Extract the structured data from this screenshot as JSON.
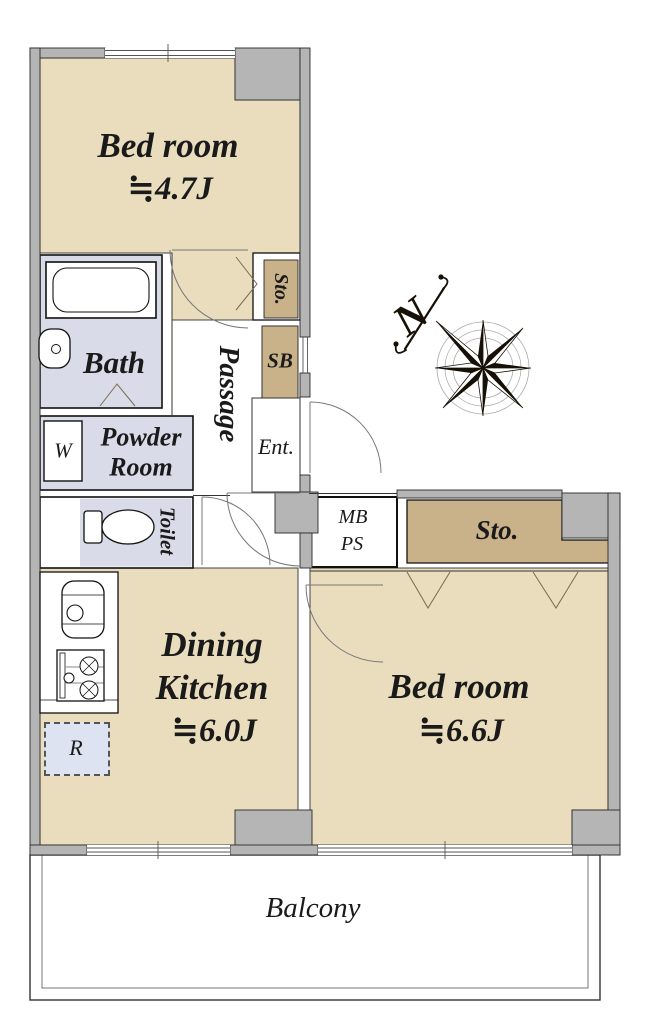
{
  "colors": {
    "room_fill": "#e9ddbe",
    "closet_fill": "#c9b28a",
    "wet_fill": "#d9dce8",
    "wall_fill": "#b5b5b5",
    "fridge_fill": "#dde3f0",
    "ink": "#1a1a1a"
  },
  "rooms": {
    "bedroom1": {
      "name": "Bed room",
      "size": "≒4.7J"
    },
    "bedroom2": {
      "name": "Bed room",
      "size": "≒6.6J"
    },
    "dining_kitchen": {
      "name_line1": "Dining",
      "name_line2": "Kitchen",
      "size": "≒6.0J"
    },
    "bath": {
      "name": "Bath"
    },
    "powder_room": {
      "line1": "Powder",
      "line2": "Room"
    },
    "toilet": {
      "name": "Toilet"
    },
    "passage": {
      "name": "Passage"
    },
    "entrance": {
      "name": "Ent."
    },
    "shoe_box": {
      "name": "SB"
    },
    "storage_top": {
      "name": "Sto."
    },
    "storage_right": {
      "name": "Sto."
    },
    "meter_pipe_box": {
      "line1": "MB",
      "line2": "PS"
    },
    "washer": {
      "name": "W"
    },
    "refrigerator": {
      "name": "R"
    },
    "balcony": {
      "name": "Balcony"
    }
  },
  "compass": {
    "north_label": "N"
  }
}
